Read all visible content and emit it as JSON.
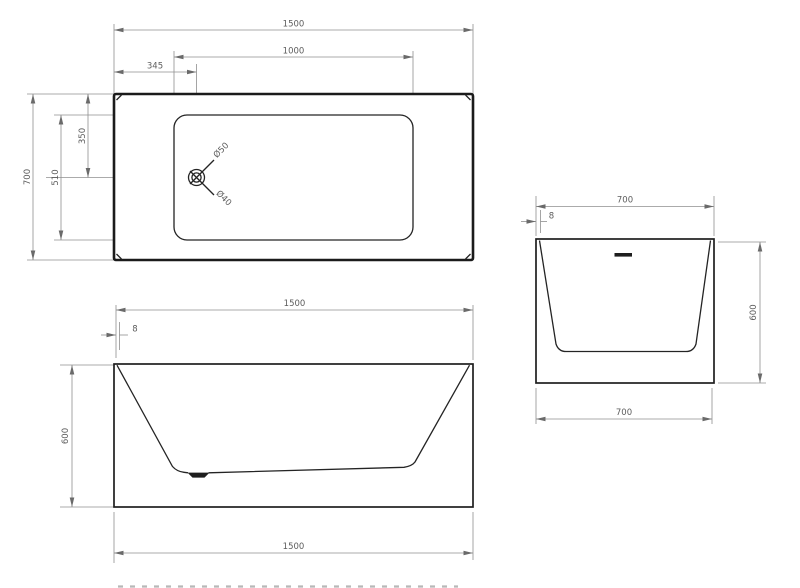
{
  "drawing_type": "bathtub technical drawing, three orthographic views",
  "colors": {
    "background": "#ffffff",
    "outline": "#1b1b1b",
    "dimension_lines": "#8f8f8f",
    "dimension_text": "#5c5c5c",
    "drain_fill": "#1e1e1e"
  },
  "top_view": {
    "overall_length": "1500",
    "inner_basin_length": "1000",
    "drain_offset_from_left": "345",
    "overall_width": "700",
    "drain_offset_from_top": "350",
    "inner_basin_width": "510",
    "drain_outer_diameter": "Ø50",
    "drain_inner_diameter": "Ø40"
  },
  "front_view": {
    "overall_length_top": "1500",
    "rim_thickness": "8",
    "inner_depth": "466",
    "overall_height": "600",
    "overall_length_bottom": "1500"
  },
  "side_view": {
    "overall_width_top": "700",
    "rim_thickness": "8",
    "overflow_width": "80",
    "overflow_offset_from_rim": "63",
    "overflow_height": "8",
    "overall_height": "600",
    "overall_width_bottom": "700"
  }
}
